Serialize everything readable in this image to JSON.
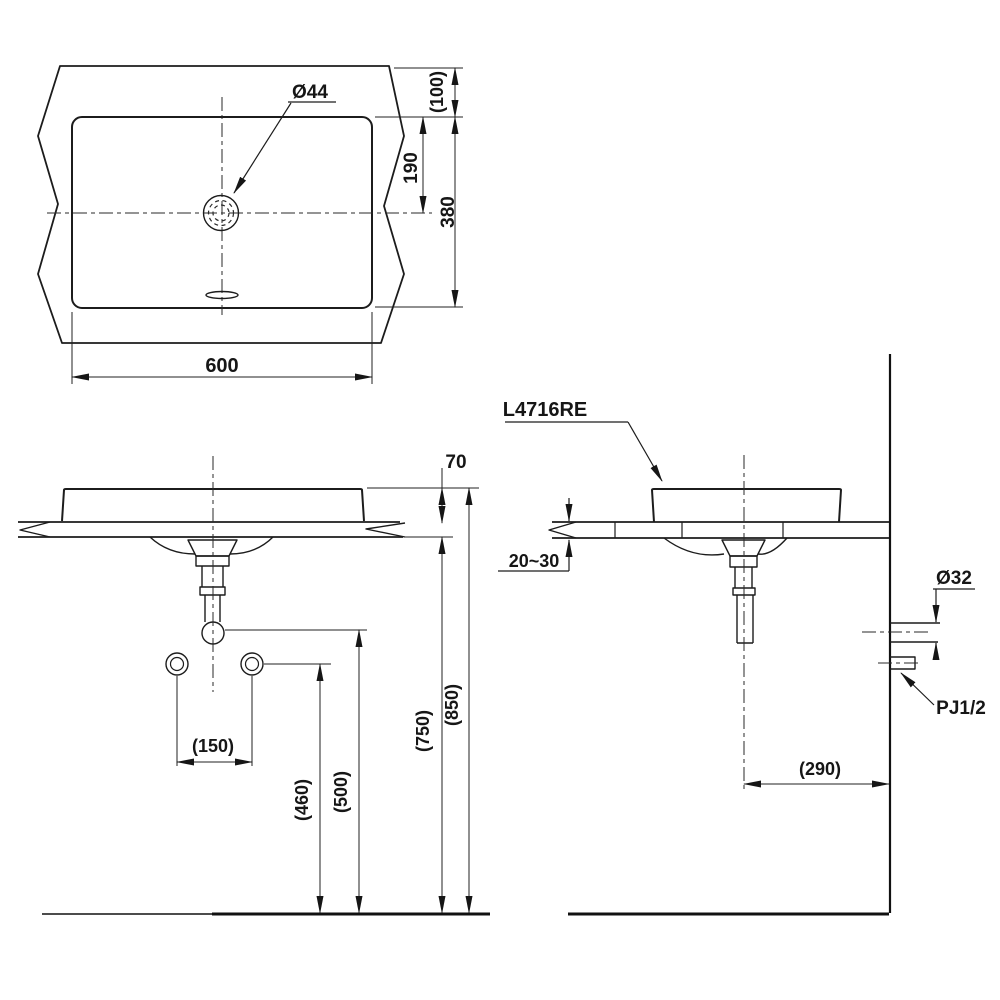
{
  "drawing": {
    "background_color": "#ffffff",
    "line_color": "#1c1c1c",
    "views": {
      "plan_view": {
        "hole_diameter": "Ø44",
        "rim_to_counter_edge": "(100)",
        "hole_center_from_rim": "190",
        "basin_depth": "380",
        "basin_width": "600"
      },
      "front_view": {
        "basin_height_above_counter": "70",
        "supply_spacing": "(150)",
        "supply_height": "(460)",
        "drain_outlet_height": "(500)",
        "counter_underside_height": "(750)",
        "rim_height": "(850)"
      },
      "side_view": {
        "model_code": "L4716RE",
        "counter_thickness": "20~30",
        "wall_drain_diameter": "Ø32",
        "supply_connection": "PJ1/2",
        "drain_center_to_wall": "(290)"
      }
    }
  }
}
